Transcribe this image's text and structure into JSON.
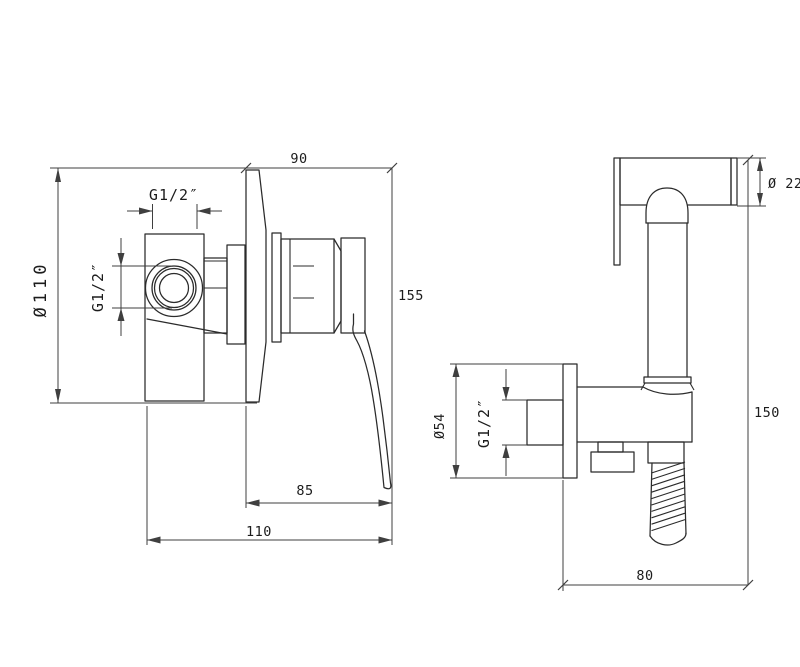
{
  "colors": {
    "line": "#2b2b2b",
    "dim": "#3f3f3f",
    "background": "#ffffff"
  },
  "left_view": {
    "overall_depth": "90",
    "top_thread": "G1/2″",
    "plate_diameter": "Ø110",
    "side_thread": "G1/2″",
    "overall_height": "155",
    "handle_depth": "85",
    "total_depth": "110"
  },
  "right_view": {
    "head_diameter": "Ø 22",
    "overall_height": "150",
    "flange_diameter": "Ø54",
    "inlet_thread": "G1/2″",
    "bracket_depth": "80"
  }
}
